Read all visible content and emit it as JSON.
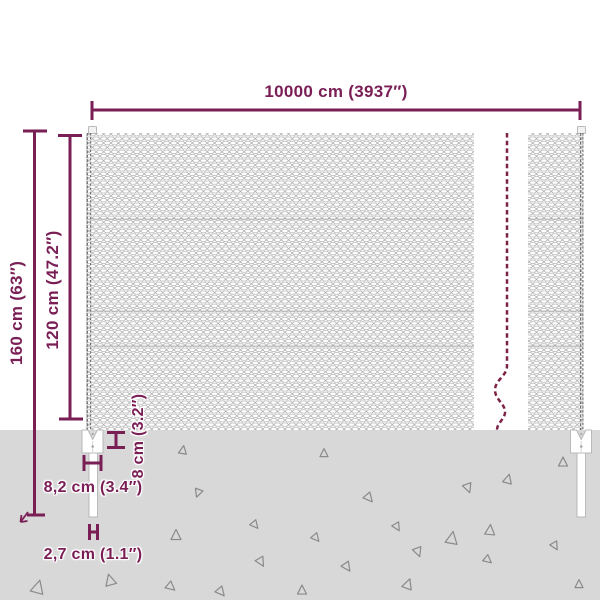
{
  "diagram": {
    "name": "chain-link-fence-dimension-diagram",
    "labels": {
      "total_length": "10000 cm (3937″)",
      "post_height": "160 cm (63″)",
      "fence_height": "120 cm (47.2″)",
      "anchor_depth": "8 cm (3.2″)",
      "anchor_width": "8,2 cm (3.4″)",
      "spike_width": "2,7 cm (1.1″)"
    },
    "colors": {
      "dimension_accent": "#7a1e56",
      "break_line": "#7c2246",
      "ground": "#d8d8d8",
      "mesh_line": "#a6a6a6",
      "triangle_line": "#8a8a8a",
      "post_outline": "#b9b9b9"
    },
    "ground": {
      "triangles": [
        [
          183,
          450,
          8,
          10
        ],
        [
          198,
          493,
          8,
          200
        ],
        [
          255,
          525,
          8,
          140
        ],
        [
          176,
          535,
          10,
          0
        ],
        [
          261,
          562,
          9,
          150
        ],
        [
          38,
          587,
          13,
          15
        ],
        [
          110,
          580,
          11,
          345
        ],
        [
          171,
          587,
          9,
          130
        ],
        [
          221,
          592,
          9,
          140
        ],
        [
          324,
          453,
          8,
          0
        ],
        [
          563,
          462,
          9,
          0
        ],
        [
          508,
          479,
          9,
          15
        ],
        [
          468,
          488,
          9,
          160
        ],
        [
          369,
          498,
          9,
          140
        ],
        [
          397,
          527,
          8,
          150
        ],
        [
          316,
          538,
          8,
          140
        ],
        [
          452,
          538,
          12,
          10
        ],
        [
          490,
          530,
          10,
          5
        ],
        [
          555,
          546,
          8,
          150
        ],
        [
          418,
          552,
          9,
          160
        ],
        [
          488,
          560,
          8,
          130
        ],
        [
          347,
          567,
          9,
          145
        ],
        [
          408,
          584,
          10,
          20
        ],
        [
          579,
          584,
          8,
          0
        ],
        [
          302,
          590,
          9,
          0
        ]
      ]
    }
  }
}
